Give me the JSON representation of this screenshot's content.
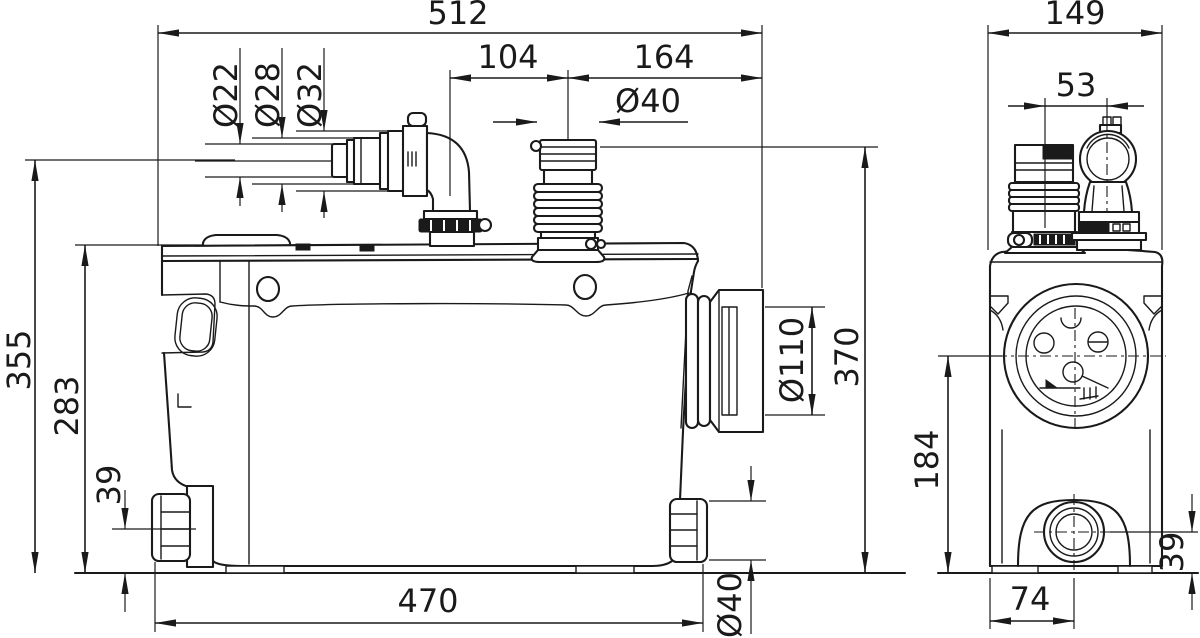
{
  "colors": {
    "line": "#1a1a1a",
    "background": "#ffffff"
  },
  "dims": {
    "front": {
      "overall_width": "512",
      "inlet_elbow_offset": "104",
      "outlet_offset": "164",
      "outlet_dia": "Ø40",
      "inlet_step_dia_small": "Ø22",
      "inlet_step_dia_mid": "Ø28",
      "inlet_step_dia_large": "Ø32",
      "inlet_center_height": "355",
      "tank_height": "283",
      "side_port_center_height": "39",
      "discharge_dia": "Ø110",
      "overall_height": "370",
      "base_length": "470",
      "side_port_dia": "Ø40"
    },
    "side": {
      "overall_depth": "149",
      "top_port_spacing": "53",
      "discharge_center_height": "184",
      "side_port_center_height": "39",
      "side_port_center_offset": "74"
    }
  }
}
